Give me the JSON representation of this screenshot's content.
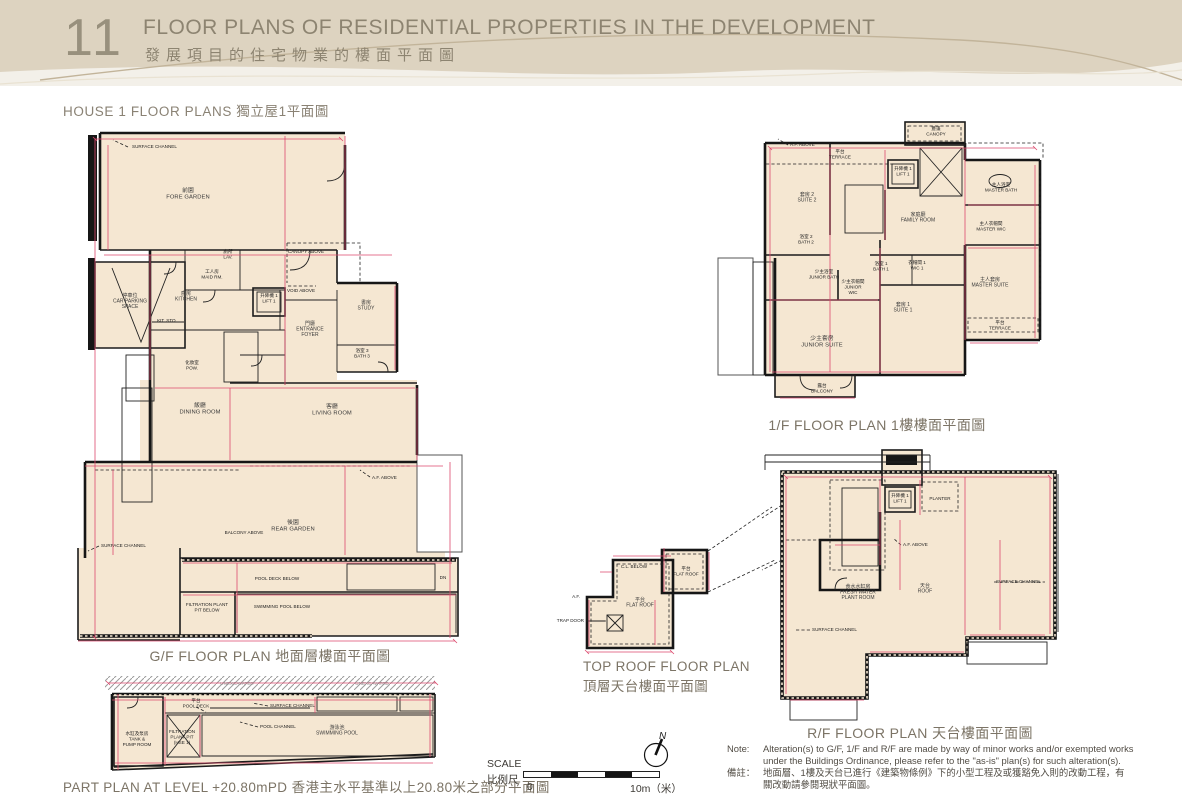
{
  "header": {
    "number": "11",
    "title_en": "FLOOR PLANS OF RESIDENTIAL PROPERTIES IN THE DEVELOPMENT",
    "title_zh": "發展項目的住宅物業的樓面平面圖"
  },
  "section": {
    "heading": "HOUSE 1 FLOOR PLANS 獨立屋1平面圖"
  },
  "plans": {
    "gf": {
      "caption": "G/F FLOOR PLAN 地面層樓面平面圖",
      "labels": [
        {
          "x": 188,
          "y": 192,
          "lines": [
            "前園",
            "FORE GARDEN"
          ],
          "c": "room"
        },
        {
          "x": 130,
          "y": 297,
          "lines": [
            "停車位",
            "CAR PARKING",
            "SPACE"
          ],
          "c": "small"
        },
        {
          "x": 186,
          "y": 295,
          "lines": [
            "廚房",
            "KITCHEN"
          ],
          "c": "small"
        },
        {
          "x": 167,
          "y": 322,
          "lines": [
            "KIT. STO."
          ],
          "c": "ann"
        },
        {
          "x": 212,
          "y": 273,
          "lines": [
            "工人房",
            "MAID RM."
          ],
          "c": "ann"
        },
        {
          "x": 228,
          "y": 253,
          "lines": [
            "廁所",
            "LAV."
          ],
          "c": "ann"
        },
        {
          "x": 269,
          "y": 297,
          "lines": [
            "升降機 1",
            "LIFT 1"
          ],
          "c": "ann"
        },
        {
          "x": 192,
          "y": 364,
          "lines": [
            "化妝室",
            "POW."
          ],
          "c": "ann"
        },
        {
          "x": 310,
          "y": 325,
          "lines": [
            "門廳",
            "ENTRANCE",
            "FOYER"
          ],
          "c": "small"
        },
        {
          "x": 366,
          "y": 304,
          "lines": [
            "書房",
            "STUDY"
          ],
          "c": "small"
        },
        {
          "x": 362,
          "y": 352,
          "lines": [
            "浴室 3",
            "BATH 3"
          ],
          "c": "ann"
        },
        {
          "x": 200,
          "y": 407,
          "lines": [
            "飯廳",
            "DINING ROOM"
          ],
          "c": "room"
        },
        {
          "x": 332,
          "y": 408,
          "lines": [
            "客廳",
            "LIVING ROOM"
          ],
          "c": "room"
        },
        {
          "x": 293,
          "y": 524,
          "lines": [
            "後園",
            "REAR GARDEN"
          ],
          "c": "room"
        },
        {
          "x": 132,
          "y": 148,
          "lines": [
            "SURFACE CHANNEL"
          ],
          "c": "ann",
          "a": "start"
        },
        {
          "x": 306,
          "y": 253,
          "lines": [
            "CANOPY ABOVE"
          ],
          "c": "ann"
        },
        {
          "x": 301,
          "y": 292,
          "lines": [
            "VOID ABOVE"
          ],
          "c": "ann"
        },
        {
          "x": 372,
          "y": 479,
          "lines": [
            "A.F. ABOVE"
          ],
          "c": "ann",
          "a": "start"
        },
        {
          "x": 244,
          "y": 534,
          "lines": [
            "BALCONY ABOVE"
          ],
          "c": "ann"
        },
        {
          "x": 101,
          "y": 547,
          "lines": [
            "SURFACE CHANNEL"
          ],
          "c": "ann",
          "a": "start"
        },
        {
          "x": 277,
          "y": 580,
          "lines": [
            "POOL DECK BELOW"
          ],
          "c": "ann"
        },
        {
          "x": 282,
          "y": 608,
          "lines": [
            "SWIMMING POOL BELOW"
          ],
          "c": "ann"
        },
        {
          "x": 207,
          "y": 606,
          "lines": [
            "FILTRATION PLANT",
            "PIT BELOW"
          ],
          "c": "ann"
        },
        {
          "x": 443,
          "y": 579,
          "lines": [
            "DN"
          ],
          "c": "ann"
        }
      ]
    },
    "part": {
      "caption": "PART PLAN AT LEVEL +20.80mPD 香港主水平基準以上20.80米之部分平面圖",
      "labels": [
        {
          "x": 237,
          "y": 685,
          "lines": [
            "UNEXCAVATED"
          ],
          "c": "gray"
        },
        {
          "x": 372,
          "y": 685,
          "lines": [
            "UNEXCAVATED"
          ],
          "c": "gray"
        },
        {
          "x": 196,
          "y": 702,
          "lines": [
            "平台",
            "POOL DECK"
          ],
          "c": "ann"
        },
        {
          "x": 270,
          "y": 707,
          "lines": [
            "SURFACE CHANNEL"
          ],
          "c": "ann",
          "a": "start"
        },
        {
          "x": 260,
          "y": 728,
          "lines": [
            "POOL CHANNEL"
          ],
          "c": "ann",
          "a": "start"
        },
        {
          "x": 337,
          "y": 729,
          "lines": [
            "游泳池",
            "SWIMMING POOL"
          ],
          "c": "small"
        },
        {
          "x": 137,
          "y": 735,
          "lines": [
            "水缸及泵房",
            "TANK &",
            "PUMP ROOM"
          ],
          "c": "ann"
        },
        {
          "x": 182,
          "y": 733,
          "lines": [
            "FILTRATION",
            "PLANT PIT",
            "(HSE 1)"
          ],
          "c": "ann"
        }
      ]
    },
    "f1": {
      "caption": "1/F FLOOR PLAN 1樓樓面平面圖",
      "labels": [
        {
          "x": 840,
          "y": 153,
          "lines": [
            "平台",
            "TERRACE"
          ],
          "c": "ann"
        },
        {
          "x": 936,
          "y": 130,
          "lines": [
            "簷篷",
            "CANOPY"
          ],
          "c": "ann"
        },
        {
          "x": 903,
          "y": 170,
          "lines": [
            "升降機 1",
            "LIFT 1"
          ],
          "c": "ann"
        },
        {
          "x": 807,
          "y": 196,
          "lines": [
            "套房 2",
            "SUITE 2"
          ],
          "c": "small"
        },
        {
          "x": 918,
          "y": 216,
          "lines": [
            "家庭廳",
            "FAMILY ROOM"
          ],
          "c": "small"
        },
        {
          "x": 1001,
          "y": 186,
          "lines": [
            "主人浴室",
            "MASTER BATH"
          ],
          "c": "ann"
        },
        {
          "x": 991,
          "y": 225,
          "lines": [
            "主人衣帽間",
            "MASTER WIC"
          ],
          "c": "ann"
        },
        {
          "x": 806,
          "y": 238,
          "lines": [
            "浴室 2",
            "BATH 2"
          ],
          "c": "ann"
        },
        {
          "x": 824,
          "y": 273,
          "lines": [
            "少主浴室",
            "JUNIOR BATH"
          ],
          "c": "ann"
        },
        {
          "x": 853,
          "y": 283,
          "lines": [
            "少主衣帽間",
            "JUNIOR",
            "WIC"
          ],
          "c": "ann"
        },
        {
          "x": 881,
          "y": 265,
          "lines": [
            "浴室 1",
            "BATH 1"
          ],
          "c": "ann"
        },
        {
          "x": 917,
          "y": 264,
          "lines": [
            "衣帽間 1",
            "WIC 1"
          ],
          "c": "ann"
        },
        {
          "x": 990,
          "y": 281,
          "lines": [
            "主人套房",
            "MASTER SUITE"
          ],
          "c": "small"
        },
        {
          "x": 903,
          "y": 306,
          "lines": [
            "套房 1",
            "SUITE 1"
          ],
          "c": "small"
        },
        {
          "x": 822,
          "y": 340,
          "lines": [
            "少主套房",
            "JUNIOR SUITE"
          ],
          "c": "room"
        },
        {
          "x": 1000,
          "y": 324,
          "lines": [
            "平台",
            "TERRACE"
          ],
          "c": "ann"
        },
        {
          "x": 822,
          "y": 387,
          "lines": [
            "露台",
            "BALCONY"
          ],
          "c": "ann"
        },
        {
          "x": 790,
          "y": 146,
          "lines": [
            "A.F. ABOVE"
          ],
          "c": "ann",
          "a": "start"
        }
      ]
    },
    "toproof": {
      "caption_en": "TOP ROOF FLOOR PLAN",
      "caption_zh": "頂層天台樓面平面圖",
      "labels": [
        {
          "x": 686,
          "y": 570,
          "lines": [
            "平台",
            "FLAT ROOF"
          ],
          "c": "ann"
        },
        {
          "x": 640,
          "y": 601,
          "lines": [
            "平台",
            "FLAT ROOF"
          ],
          "c": "small"
        },
        {
          "x": 584,
          "y": 622,
          "lines": [
            "TRAP DOOR"
          ],
          "c": "ann",
          "a": "end"
        },
        {
          "x": 634,
          "y": 568,
          "lines": [
            "C.L. BELOW"
          ],
          "c": "ann"
        },
        {
          "x": 580,
          "y": 598,
          "lines": [
            "A.F."
          ],
          "c": "ann",
          "a": "end"
        }
      ]
    },
    "rf": {
      "caption": "R/F FLOOR PLAN 天台樓面平面圖",
      "labels": [
        {
          "x": 900,
          "y": 497,
          "lines": [
            "升降機 1",
            "LIFT 1"
          ],
          "c": "ann"
        },
        {
          "x": 940,
          "y": 500,
          "lines": [
            "PLANTER"
          ],
          "c": "ann"
        },
        {
          "x": 858,
          "y": 588,
          "lines": [
            "食水水缸房",
            "FRESH WATER",
            "PLANT ROOM"
          ],
          "c": "small"
        },
        {
          "x": 925,
          "y": 587,
          "lines": [
            "天台",
            "ROOF"
          ],
          "c": "small"
        },
        {
          "x": 996,
          "y": 583,
          "lines": [
            "SURFACE CHANNEL"
          ],
          "c": "ann",
          "a": "start"
        },
        {
          "x": 812,
          "y": 631,
          "lines": [
            "SURFACE CHANNEL"
          ],
          "c": "ann",
          "a": "start"
        },
        {
          "x": 903,
          "y": 546,
          "lines": [
            "A.F. ABOVE"
          ],
          "c": "ann",
          "a": "start"
        }
      ]
    }
  },
  "scale": {
    "label_en": "SCALE",
    "label_zh": "比例尺",
    "start": "0",
    "end": "10m（米）"
  },
  "compass": {
    "label": "N"
  },
  "note": {
    "label_en": "Note:",
    "en": [
      "Alteration(s) to G/F, 1/F and R/F are made by way of minor works and/or exempted works",
      "under the Buildings Ordinance, please refer to the \"as-is\" plan(s) for such alteration(s)."
    ],
    "label_zh": "備註：",
    "zh": [
      "地面層、1樓及天台已進行《建築物條例》下的小型工程及或獲豁免入則的改動工程，有",
      "關改動請參閱現狀平面圖。"
    ]
  }
}
